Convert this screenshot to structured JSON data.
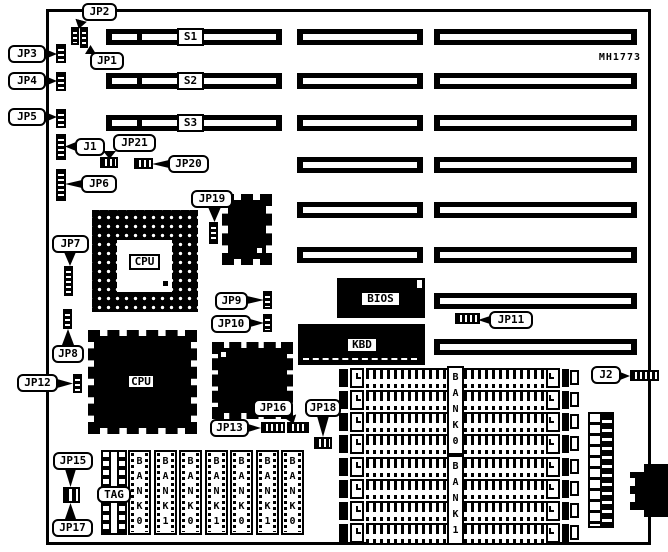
{
  "board": {
    "part_number": "MH1773"
  },
  "slots": {
    "labels": [
      "S1",
      "S2",
      "S3"
    ]
  },
  "chips": {
    "cpu_socket": "CPU",
    "cpu": "CPU",
    "bios": "BIOS",
    "keyboard_controller": "KBD",
    "cache_tag": "TAG"
  },
  "jumpers": {
    "jp1": "JP1",
    "jp2": "JP2",
    "jp3": "JP3",
    "jp4": "JP4",
    "jp5": "JP5",
    "jp6": "JP6",
    "jp7": "JP7",
    "jp8": "JP8",
    "jp9": "JP9",
    "jp10": "JP10",
    "jp11": "JP11",
    "jp12": "JP12",
    "jp13": "JP13",
    "jp15": "JP15",
    "jp16": "JP16",
    "jp17": "JP17",
    "jp18": "JP18",
    "jp19": "JP19",
    "jp20": "JP20",
    "jp21": "JP21",
    "j1": "J1",
    "j2": "J2"
  },
  "memory": {
    "simm_banks": [
      "BANK0",
      "BANK1"
    ],
    "cache_chips": [
      "BANK0",
      "BANK1",
      "BANK0",
      "BANK1",
      "BANK0",
      "BANK1",
      "BANK0"
    ]
  }
}
